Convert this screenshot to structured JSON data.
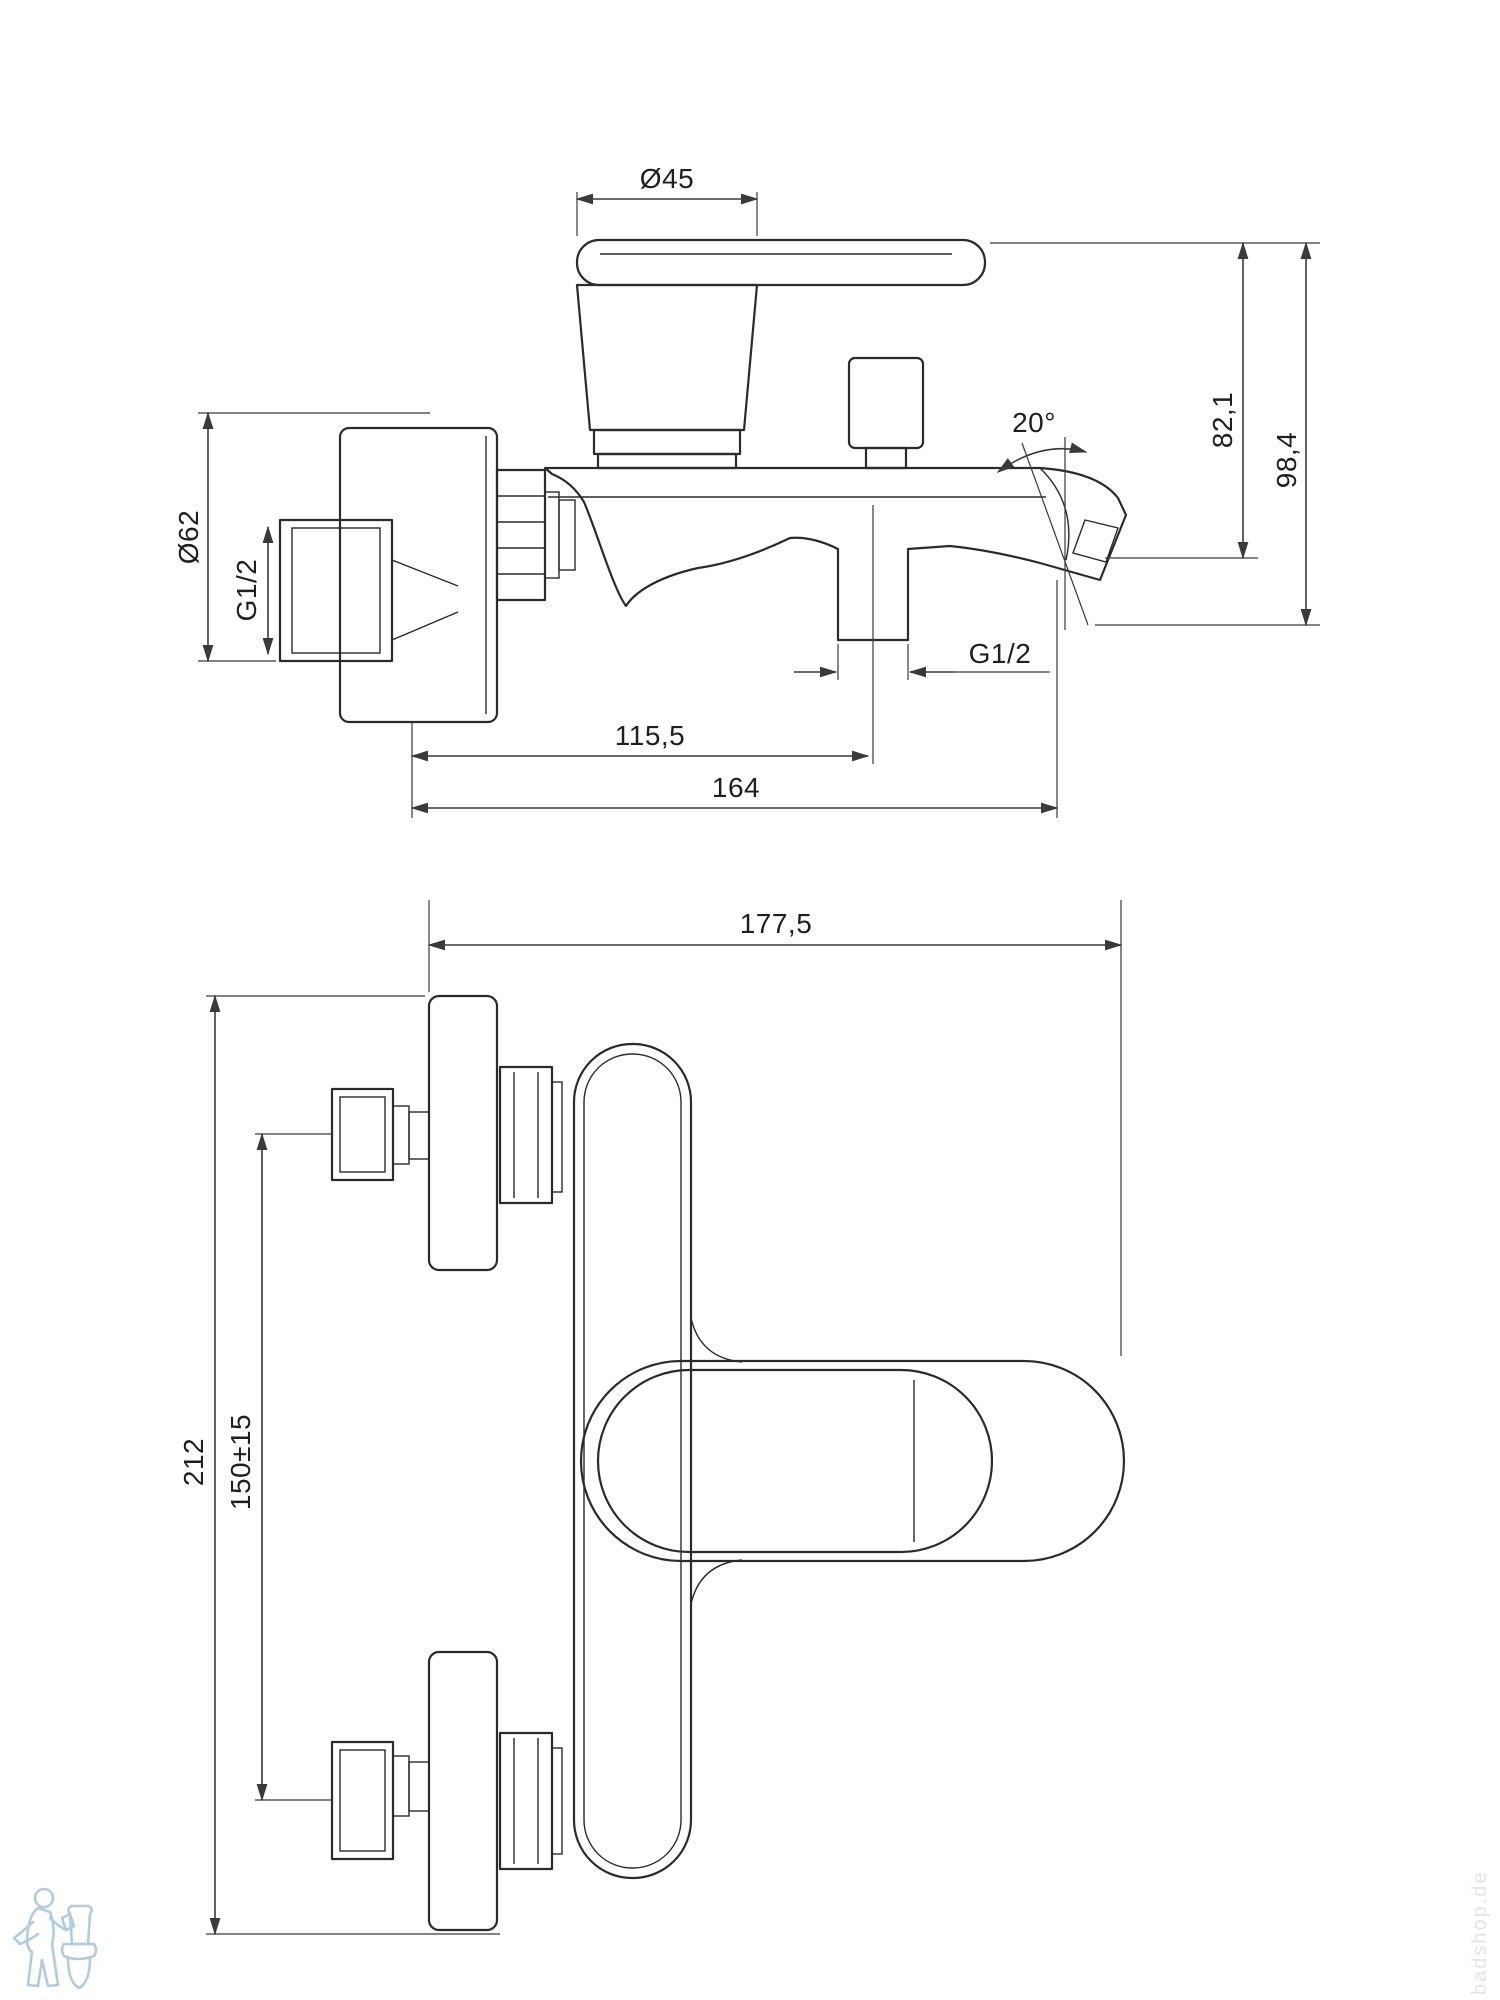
{
  "drawing": {
    "side_view": {
      "dims": {
        "cap_diameter": "Ø45",
        "height_to_spout": "82,1",
        "height_total": "98,4",
        "spout_angle": "20°",
        "flange_diameter": "Ø62",
        "wall_thread": "G1/2",
        "shower_outlet_thread": "G1/2",
        "spout_center_offset": "115,5",
        "spout_reach": "164"
      }
    },
    "front_view": {
      "dims": {
        "total_width": "177,5",
        "total_height": "212",
        "connection_distance": "150±15"
      }
    },
    "watermark": {
      "shop": "badshop.de"
    },
    "colors": {
      "line": "#2b2b2b",
      "logo_blue": "#aecde3"
    }
  }
}
